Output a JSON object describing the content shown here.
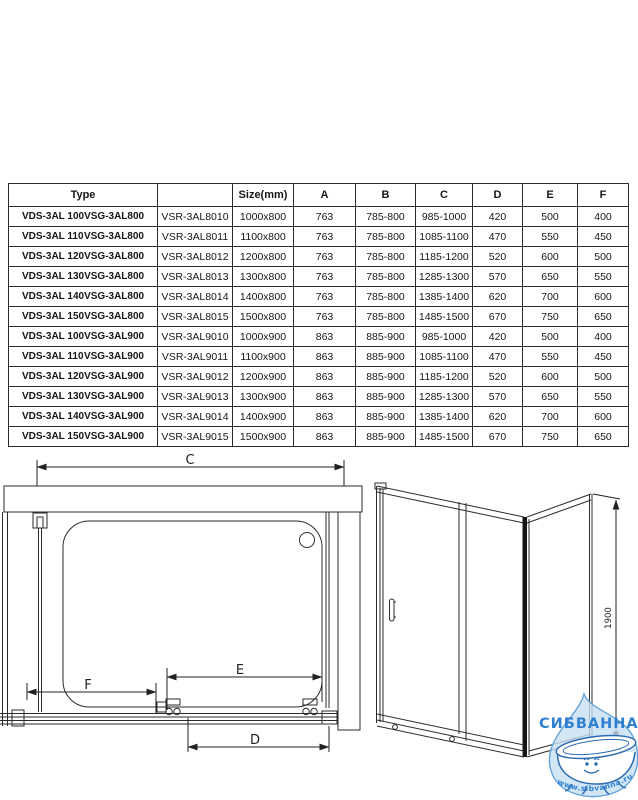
{
  "table": {
    "headers": {
      "type": "Type",
      "model": "",
      "size": "Size(mm)",
      "a": "A",
      "b": "B",
      "c": "C",
      "d": "D",
      "e": "E",
      "f": "F"
    },
    "rows": [
      {
        "type1": "VDS-3AL 100",
        "type2": "VSG-3AL800",
        "model": "VSR-3AL8010",
        "size": "1000x800",
        "a": "763",
        "b": "785-800",
        "c": "985-1000",
        "d": "420",
        "e": "500",
        "f": "400"
      },
      {
        "type1": "VDS-3AL 110",
        "type2": "VSG-3AL800",
        "model": "VSR-3AL8011",
        "size": "1100x800",
        "a": "763",
        "b": "785-800",
        "c": "1085-1100",
        "d": "470",
        "e": "550",
        "f": "450"
      },
      {
        "type1": "VDS-3AL 120",
        "type2": "VSG-3AL800",
        "model": "VSR-3AL8012",
        "size": "1200x800",
        "a": "763",
        "b": "785-800",
        "c": "1185-1200",
        "d": "520",
        "e": "600",
        "f": "500"
      },
      {
        "type1": "VDS-3AL 130",
        "type2": "VSG-3AL800",
        "model": "VSR-3AL8013",
        "size": "1300x800",
        "a": "763",
        "b": "785-800",
        "c": "1285-1300",
        "d": "570",
        "e": "650",
        "f": "550"
      },
      {
        "type1": "VDS-3AL 140",
        "type2": "VSG-3AL800",
        "model": "VSR-3AL8014",
        "size": "1400x800",
        "a": "763",
        "b": "785-800",
        "c": "1385-1400",
        "d": "620",
        "e": "700",
        "f": "600"
      },
      {
        "type1": "VDS-3AL 150",
        "type2": "VSG-3AL800",
        "model": "VSR-3AL8015",
        "size": "1500x800",
        "a": "763",
        "b": "785-800",
        "c": "1485-1500",
        "d": "670",
        "e": "750",
        "f": "650"
      },
      {
        "type1": "VDS-3AL 100",
        "type2": "VSG-3AL900",
        "model": "VSR-3AL9010",
        "size": "1000x900",
        "a": "863",
        "b": "885-900",
        "c": "985-1000",
        "d": "420",
        "e": "500",
        "f": "400"
      },
      {
        "type1": "VDS-3AL 110",
        "type2": "VSG-3AL900",
        "model": "VSR-3AL9011",
        "size": "1100x900",
        "a": "863",
        "b": "885-900",
        "c": "1085-1100",
        "d": "470",
        "e": "550",
        "f": "450"
      },
      {
        "type1": "VDS-3AL 120",
        "type2": "VSG-3AL900",
        "model": "VSR-3AL9012",
        "size": "1200x900",
        "a": "863",
        "b": "885-900",
        "c": "1185-1200",
        "d": "520",
        "e": "600",
        "f": "500"
      },
      {
        "type1": "VDS-3AL 130",
        "type2": "VSG-3AL900",
        "model": "VSR-3AL9013",
        "size": "1300x900",
        "a": "863",
        "b": "885-900",
        "c": "1285-1300",
        "d": "570",
        "e": "650",
        "f": "550"
      },
      {
        "type1": "VDS-3AL 140",
        "type2": "VSG-3AL900",
        "model": "VSR-3AL9014",
        "size": "1400x900",
        "a": "863",
        "b": "885-900",
        "c": "1385-1400",
        "d": "620",
        "e": "700",
        "f": "600"
      },
      {
        "type1": "VDS-3AL 150",
        "type2": "VSG-3AL900",
        "model": "VSR-3AL9015",
        "size": "1500x900",
        "a": "863",
        "b": "885-900",
        "c": "1485-1500",
        "d": "670",
        "e": "750",
        "f": "650"
      }
    ]
  },
  "diagram": {
    "dim_c": "C",
    "dim_d": "D",
    "dim_e": "E",
    "dim_f": "F",
    "dim_height": "1900"
  },
  "watermark": {
    "brand": "СИБВАННА",
    "site": "www.sibvanna.ru",
    "brand_color": "#2f7fd0",
    "drop_fill": "#c7e0f4",
    "drop_stroke": "#63a4da",
    "tub_stroke": "#2d6cb3"
  }
}
